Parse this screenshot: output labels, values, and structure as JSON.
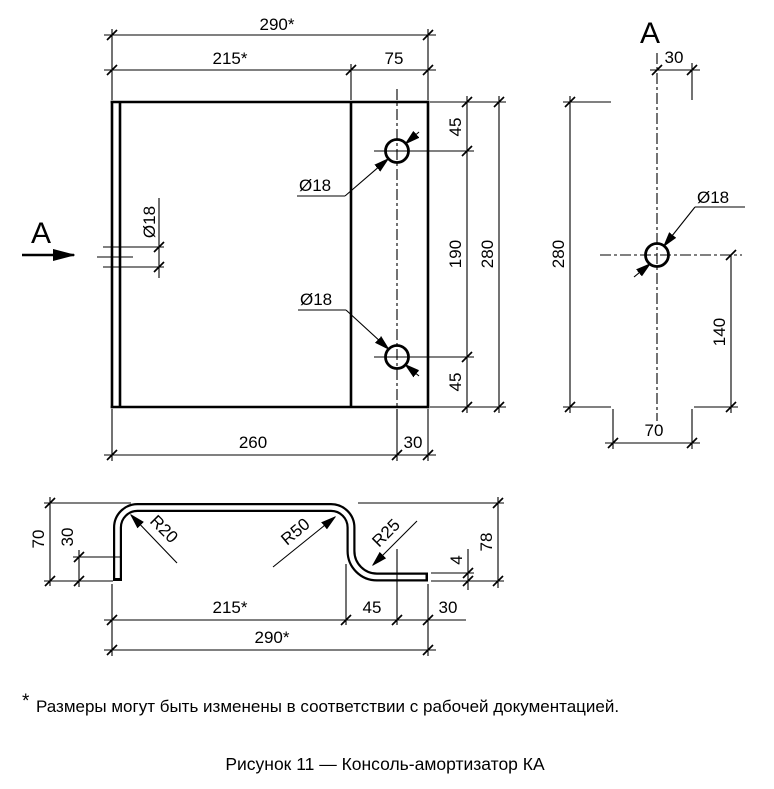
{
  "figure": {
    "caption": "Рисунок 11 — Консоль-амортизатор КА",
    "footnote_star": "*",
    "footnote": "Размеры могут быть изменены в соответствии с рабочей документацией.",
    "line_color": "#000000",
    "background": "#ffffff"
  },
  "front_view": {
    "section_arrow_label": "А",
    "dim_width_total": "290*",
    "dim_width_left": "215*",
    "dim_width_right": "75",
    "dim_45_top": "45",
    "dim_190": "190",
    "dim_280": "280",
    "dim_45_bottom": "45",
    "dim_260": "260",
    "dim_30_bottom": "30",
    "hole_top_label": "Ø18",
    "hole_bottom_label": "Ø18",
    "hole_left_label": "Ø18"
  },
  "section_view": {
    "title": "А",
    "dim_30_top": "30",
    "dim_height_280": "280",
    "hole_label": "Ø18",
    "dim_140": "140",
    "dim_70_bottom": "70"
  },
  "profile_view": {
    "dim_70": "70",
    "dim_30_left": "30",
    "radius_r20": "R20",
    "radius_r50": "R50",
    "radius_r25": "R25",
    "dim_78": "78",
    "dim_4": "4",
    "dim_215": "215*",
    "dim_45": "45",
    "dim_30_right": "30",
    "dim_290": "290*"
  }
}
